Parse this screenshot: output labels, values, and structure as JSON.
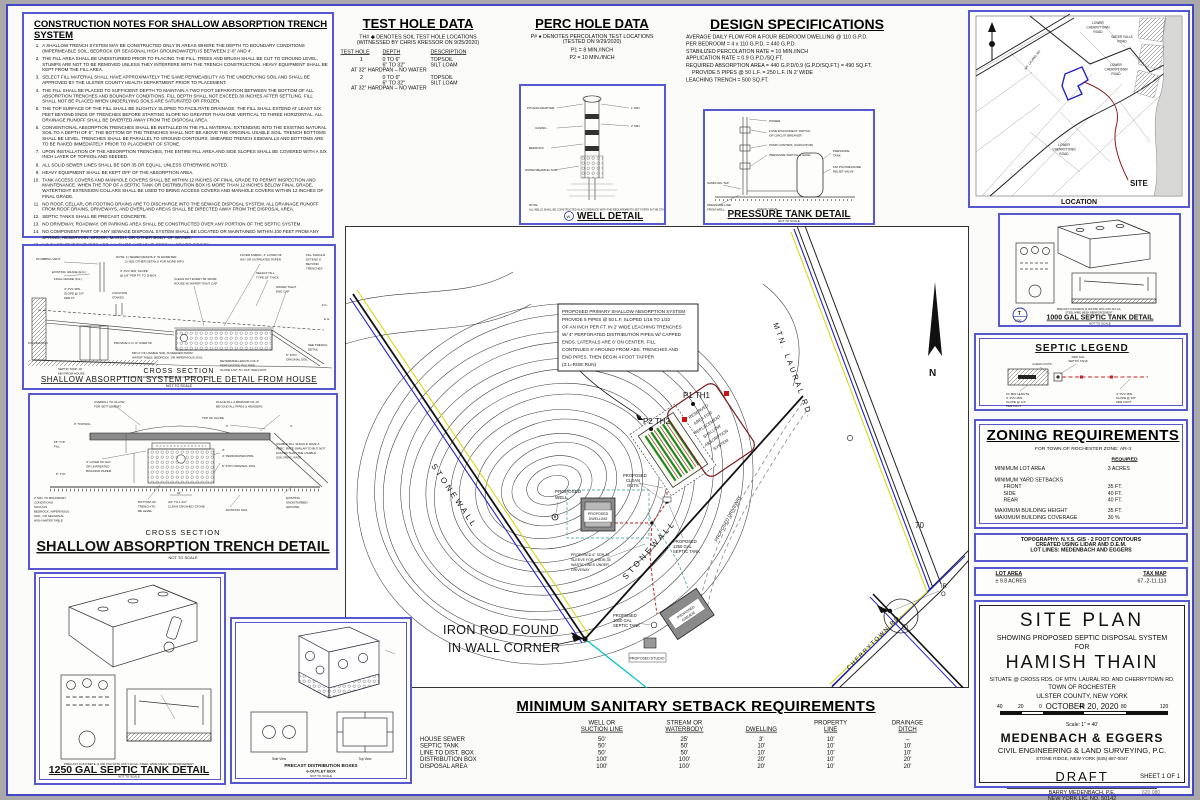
{
  "notes": {
    "title": "CONSTRUCTION NOTES FOR SHALLOW ABSORPTION TRENCH SYSTEM",
    "items": [
      "A SHALLOW TRENCH SYSTEM MAY BE CONSTRUCTED ONLY IN AREAS WHERE THE DEPTH TO BOUNDARY CONDITIONS (IMPERMEABLE SOIL, BEDROCK OR SEASONAL HIGH GROUNDWATER) IS BETWEEN 2'-6\" AND 4'.",
      "THE FILL AREA SHALL BE UNDISTURBED PRIOR TO PLACING THE FILL.  TREES AND BRUSH SHALL BE CUT TO GROUND LEVEL.  STUMPS ARE NOT TO BE REMOVED UNLESS THEY INTERFERE WITH THE TRENCH CONSTRUCTION.  HEAVY EQUIPMENT SHALL BE KEPT FROM THE FILL AREA.",
      "SELECT FILL MATERIAL SHALL HAVE APPROXIMATELY THE SAME PERMEABILITY AS THE UNDERLYING SOIL AND SHALL BE APPROVED BY THE ULSTER COUNTY HEALTH DEPARTMENT PRIOR TO PLACEMENT.",
      "THE FILL SHALL BE PLACED TO SUFFICIENT DEPTH TO MAINTAIN A TWO FOOT SEPARATION BETWEEN THE BOTTOM OF ALL ABSORPTION TRENCHES AND BOUNDARY CONDITIONS.  FILL DEPTH SHALL NOT EXCEED 30 INCHES AFTER SETTLING.  FILL SHALL NOT BE PLACED WHEN UNDERLYING SOILS ARE SATURATED OR FROZEN.",
      "THE TOP SURFACE OF THE FILL SHALL BE SLIGHTLY SLOPED TO FACILITATE DRAINAGE.  THE FILL SHALL EXTEND AT LEAST SIX FEET BEYOND ENDS OF TRENCHES BEFORE STARTING SLOPE NO GREATER THAN ONE VERTICAL TO THREE HORIZONTAL.  ALL DRAINAGE RUNOFF SHALL BE DIVERTED AWAY FROM THE DISPOSAL AREA.",
      "CONVENTIONAL ABSORPTION TRENCHES SHALL BE INSTALLED IN THE FILL MATERIAL, EXTENDING INTO THE EXISTING NATURAL SOIL TO A DEPTH OF 6\".  THE BOTTOM OF THE TRENCHES SHALL NOT BE ABOVE THE ORIGINAL USABLE SOIL.  TRENCH BOTTOMS SHALL BE LEVEL.  TRENCHES SHALL BE PARALLEL TO GROUND CONTOURS.  SMEARED TRENCH SIDEWALLS AND BOTTOMS ARE TO BE RAKED IMMEDIATELY PRIOR TO PLACEMENT OF STONE.",
      "UPON INSTALLATION OF THE ABSORPTION TRENCHES, THE ENTIRE FILL AREA AND SIDE SLOPES SHALL BE COVERED WITH A SIX INCH LAYER OF TOPSOIL AND SEEDED.",
      "ALL SOLID SEWER LINES SHALL BE SDR 35 OR EQUAL, UNLESS OTHERWISE NOTED.",
      "HEAVY EQUIPMENT SHALL BE KEPT OFF OF THE ABSORPTION AREA.",
      "TANK ACCESS COVERS AND MANHOLE COVERS SHALL BE WITHIN 12 INCHES OF FINAL GRADE TO PERMIT INSPECTION AND MAINTENANCE.  WHEN THE TOP OF A SEPTIC TANK OR DISTRIBUTION BOX IS MORE THAN 12 INCHES BELOW FINAL GRADE, WATERTIGHT EXTENSION COLLARS SHALL BE USED TO BRING ACCESS COVERS AND MANHOLE COVERS WITHIN 12 INCHES OF FINAL GRADE.",
      "NO ROOF, CELLAR, OR FOOTING DRAINS ARE TO DISCHARGE INTO THE SEWAGE DISPOSAL SYSTEM.  ALL DRAINAGE RUNOFF FROM ROOF DRAINS, DRIVEWAYS, AND OVERLAND AREAS SHALL BE DIRECTED AWAY FROM THE DISPOSAL AREA.",
      "SEPTIC TANKS SHALL BE PRECAST CONCRETE.",
      "NO DRIVEWAY, ROADWAY, OR PARKING AREA SHALL BE CONSTRUCTED OVER ANY PORTION OF THE SEPTIC SYSTEM.",
      "NO COMPONENT PART OF ANY SEWAGE DISPOSAL SYSTEM SHALL BE LOCATED OR MAINTAINED WITHIN 100 FEET FROM ANY SPRING, RESERVOIR, BROOK, MARSH, OR OTHER BODY OF WATER.",
      "NO BASEMENT FIXTURES ARE ALLOWED WITHOUT SPECIAL SEWER DESIGN.",
      "ALL CONCRETE CHAMBERS TO BE LEVELED ON A BED OF PEA GRAVEL OR SAND"
    ]
  },
  "test": {
    "title": "TEST HOLE DATA",
    "l1": "TH#",
    "l2": "DENOTES SOIL TEST HOLE LOCATIONS",
    "wit": "(WITNESSED BY CHRIS KRESSOR ON 9/25/2020)",
    "h1": "TEST HOLE",
    "h2": "DEPTH",
    "h3": "DESCRIPTION",
    "r1": {
      "id": "1",
      "a1": "0 TO 6\"",
      "b1": "TOPSOIL",
      "a2": "6\" TO 32\"",
      "b2": "SILT LOAM",
      "f": "AT 32\" HARDPAN – NO WATER"
    },
    "r2": {
      "id": "2",
      "a1": "0 TO 6\"",
      "b1": "TOPSOIL",
      "a2": "6\" TO 32\"",
      "b2": "SILT LOAM",
      "f": "AT 32\" HARDPAN – NO WATER"
    }
  },
  "perc": {
    "title": "PERC HOLE DATA",
    "l1": "P#",
    "l2": "DENOTES PERCOLATION TEST LOCATIONS",
    "t": "(TESTED ON 9/29/2020)",
    "p1": "P1 = 8 MIN./INCH",
    "p2": "P2 = 10 MIN./INCH"
  },
  "specs": {
    "title": "DESIGN SPECIFICATIONS",
    "lines": [
      "AVERAGE DAILY FLOW FOR A FOUR BEDROOM DWELLING @ 110 G.P.D.",
      "PER BEDROOM = 4 x 110 G.P.D. = 440 G.P.D.",
      "STABILIZED PERCOLATION RATE = 10 MIN./INCH",
      "APPLICATION RATE = 0.9 G.P.D./SQ.FT.",
      "REQUIRED ABSORPTION AREA = 440 G.P.D/0.9 (G.P.D/SQ.FT.) = 490 SQ.FT.",
      "PROVIDE 5 PIPES @ 50 L.F. = 250 L.F. IN 2' WIDE",
      "LEACHING TRENCH = 500 SQ.FT."
    ]
  },
  "well": {
    "title": "WELL DETAIL",
    "nts": "NOT TO SCALE",
    "sym": "W",
    "note1": "NOTE:",
    "note2": "ALL WELLS SHALL BE CONSTRUCTED IN ACCORDANCE WITH THE REQUIREMENTS SET FORTH IN THE STANDARDS FOR WATER WELLS",
    "pitless": "PITLESS ADAPTER",
    "casing": "CASING",
    "bedrock": "BEDROCK",
    "water": "WATER BEARING SOIL",
    "m1": "1' MIN",
    "m2": "2' MIN"
  },
  "ptank": {
    "title": "PRESSURE TANK DETAIL",
    "nts": "NOT TO SCALE",
    "power": "POWER",
    "fuse1": "FUSE DISCONNECT SWITCH",
    "fuse2": "OR CIRCUIT BREAKER",
    "pump": "PUMP CONTROL (CAPACITOR)",
    "psw": "PRESSURE SWITCH & GAGE",
    "tank1": "PRESSURE",
    "tank2": "TANK",
    "rv1": "150 PSI PRESSURE",
    "rv2": "RELIEF VALVE",
    "tap": "SAMPLING TAP",
    "pl1": "PRESSURE LINE",
    "pl2": "FROM WELL",
    "cv": "CHECK VALVE"
  },
  "loc": {
    "caption": "LOCATION",
    "site": "SITE",
    "mtl": "MT. LAUREL RD",
    "lt1": "LOWER",
    "lt2": "CHERRYTOWN",
    "lt3": "ROAD",
    "wf1": "WATER FALLS",
    "wf2": "ROAD",
    "mid1": "LOWER",
    "mid2": "CHERRYTOWN",
    "mid3": "ROAD",
    "bot1": "LOWER",
    "bot2": "CHERRYTOWN",
    "bot3": "ROAD"
  },
  "t1000": {
    "title": "1000 GAL SEPTIC TANK DETAIL",
    "nts": "NOT TO SCALE",
    "note1": "PRECAST CONCRETE (4,000 PSI) WITH 6X6 X10 GA.",
    "note2": "STEEL WIRE MESH REINFORCEMENT",
    "symT": "T",
    "symN": "1000"
  },
  "legend": {
    "title": "SEPTIC LEGEND",
    "tk1": "1000 GAL",
    "tk2": "SEPTIC TANK",
    "co": "CLEAN OUTS",
    "ln1": "10' MIN LENGTH",
    "ln2": "4\" PVC MIN.",
    "ln3": "SLOPE @ 1/4\"",
    "ln4": "PER FOOT",
    "rn1": "4\" PVC MIN.",
    "rn2": "SLOPE @ 1/8\"",
    "rn3": "PER FOOT"
  },
  "zoning": {
    "title": "ZONING REQUIREMENTS",
    "subtitle": "FOR TOWN OF ROCHESTER ZONE: AR-3",
    "req": "REQUIRED",
    "r1": {
      "l": "MINIMUM LOT AREA",
      "v": "3 ACRES"
    },
    "r2": {
      "l": "MINIMUM YARD SETBACKS",
      "v": ""
    },
    "r3": {
      "l": "FRONT",
      "v": "35 FT."
    },
    "r4": {
      "l": "SIDE",
      "v": "40 FT."
    },
    "r5": {
      "l": "REAR",
      "v": "40 FT."
    },
    "r6": {
      "l": "MAXIMUM BUILDING HEIGHT",
      "v": "35 FT."
    },
    "r7": {
      "l": "MAXIMUM BUILDING COVERAGE",
      "v": "30 %"
    }
  },
  "topo": {
    "l1": "TOPOGRAPHY:  N.Y.S. GIS - 2 FOOT CONTOURS",
    "l2": "CREATED USING LIDAR AND D.E.M.",
    "l3": "LOT LINES: MEDENBACH AND EGGERS"
  },
  "lot": {
    "h1": "LOT AREA",
    "v1": "± 9.8 ACRES",
    "h2": "TAX MAP",
    "v2": "67.-2-11.113"
  },
  "tb": {
    "t1": "SITE PLAN",
    "t2": "SHOWING PROPOSED SEPTIC DISPOSAL SYSTEM",
    "t3": "FOR",
    "t4": "HAMISH THAIN",
    "t5": "SITUATE @ CROSS RDS. OF MTN. LAURAL RD. AND CHERRYTOWN RD.",
    "t6": "TOWN OF ROCHESTER",
    "t7": "ULSTER COUNTY, NEW YORK",
    "t8": "OCTOBER 20, 2020",
    "ticks": [
      "40",
      "20",
      "0",
      "40",
      "80",
      "120"
    ],
    "scale": "Scale: 1\" = 40'",
    "firm": "MEDENBACH & EGGERS",
    "firm2": "CIVIL ENGINEERING & LAND SURVEYING, P.C.",
    "firm3": "STONE RIDGE, NEW YORK  (845) 687-0047",
    "draft": "DRAFT",
    "eng": "BARRY MEDENBACH, P.E.",
    "lic": "NEW YORK LIC. NO. 50142",
    "sheet": "SHEET 1 OF 1",
    "docnum": "620 080"
  },
  "sb": {
    "title": "MINIMUM SANITARY SETBACK REQUIREMENTS",
    "h": [
      [
        "WELL OR",
        "SUCTION LINE"
      ],
      [
        "STREAM OR",
        "WATERBODY"
      ],
      [
        "",
        "DWELLING"
      ],
      [
        "PROPERTY",
        "LINE"
      ],
      [
        "DRAINAGE",
        "DITCH"
      ]
    ],
    "rows": [
      [
        "HOUSE SEWER",
        "50'",
        "25'",
        "3'",
        "10'",
        "–"
      ],
      [
        "SEPTIC TANK",
        "50'",
        "50'",
        "10'",
        "10'",
        "10'"
      ],
      [
        "LINE TO DIST. BOX",
        "50'",
        "50'",
        "10'",
        "10'",
        "10'"
      ],
      [
        "DISTRIBUTION BOX",
        "100'",
        "100'",
        "20'",
        "10'",
        "20'"
      ],
      [
        "DISPOSAL AREA",
        "100'",
        "100'",
        "20'",
        "10'",
        "20'"
      ]
    ]
  },
  "plan": {
    "road_a": "MTN. LAURAL RD.",
    "road_b": "CHERRYTOWN RD.",
    "wall": "STONEWALL",
    "c70": "70",
    "north": "N",
    "rod1": "IRON ROD FOUND",
    "rod2": "IN WALL CORNER",
    "p1": "P1 TH1",
    "p2": "P2 TH2",
    "well1": "PROPOSED",
    "well2": "WELL",
    "dw1": "PROPOSED",
    "dw2": "DWELLING",
    "co1": "PROPOSED",
    "co2": "CLEAN",
    "co3": "OUTS",
    "sl1": "PROPOSED 6\" SDR-35",
    "sl2": "SLEEVE FOR 4\"SDR-35",
    "sl3": "WASTE LINES UNDER",
    "sl4": "DRIVEWAY",
    "t12_1": "PROPOSED",
    "t12_2": "1250 GAL",
    "t12_3": "SEPTIC TANK",
    "t10_1": "PROPOSED",
    "t10_2": "1000 GAL",
    "t10_3": "SEPTIC TANK",
    "drv": "PROPOSED DRIVEWAY",
    "gar1": "PROPOSED",
    "gar2": "GARAGE",
    "studio": "PROPOSED STUDIO",
    "clip1": "IR",
    "clip2": "O",
    "nb1": "PROPOSED PRIMARY SHALLOW ABSORPTION SYSTEM",
    "nb2": "PROVIDE 5 PIPES @ 50 L.F, SLOPED 1/16 TO 1/32",
    "nb3": "OF AN INCH PER FT. IN 2' WIDE LEACHING TRENCHES",
    "nb4": "W/  4\" PERFORATED DISTRIBUTION PIPES W/ CAPPED",
    "nb5": "ENDS.  LATERALS ARE 6' ON CENTER. FILL",
    "nb6": "CONTINUES 6' AROUND FROM  ABS. TRENCHES AND",
    "nb7": "END PIPES. THEN BEGIN 4 FOOT TAPPER",
    "nb8": "(3:1=RISE:RUN)",
    "rv1": "RESERVED",
    "rv2": "AREA FOR",
    "rv3": "REPLACEMENT",
    "rv4": "SHALLOW",
    "rv5": "ABSORPTION",
    "rv6": "SYSTEM"
  },
  "profile": {
    "cross": "CROSS SECTION",
    "title": "SHALLOW ABSORPTION SYSTEM PROFILE DETAIL FROM HOUSE",
    "nts": "NOT TO SCALE",
    "vent": "PLUMBING VENT",
    "eg": "EXISTING GRADE (E.G.)",
    "fg": "FINAL GRADE (F.G.)",
    "pvc14a": "4\" PVC MIN.",
    "pvc14b": "SLOPE @ 1/4\"",
    "pvc14c": "PER FT.",
    "stakes1": "LOCATION",
    "stakes2": "STAKES",
    "n1": "NOTE: 1) SEWER DRAINS 4\" IN DIAMETER",
    "n2": "2) SEE OTHER DETAILS FOR MORE INFO",
    "pvc18a": "4\" PVC MIN. SLOPE",
    "pvc18b": "@ 1/8\" PER FT. TO D-BOX",
    "coa": "CLEAN OUT EVERY 50' FROM",
    "cob": "HOUSE W/ WATER TIGHT CAP",
    "fa1": "FILTER FABRIC, 4\" LAYER OF",
    "fa2": "HAY OR UNTREATED PAPER",
    "sf1": "SELECT FILL",
    "sf2": "TYPE 18\" THICK",
    "ex1": "FILL SHOULD",
    "ex2": "EXTEND 6'",
    "ex3": "BEYOND",
    "ex4": "TRENCHES",
    "cap1": "WATER TIGHT",
    "cap2": "END CAP",
    "found": "FOUNDATION",
    "st1": "SEPTIC TANK 10'",
    "st2": "MIN FROM HOUSE",
    "pr": "PROVIDE C.O. IF OVER 50'",
    "us1": "MIN 2' OF USABLE SOIL IS NEEDED FROM",
    "us2": "WATER TABLE, BEDROCK, OR IMPERVIOUS SOIL",
    "bd": "BOUNDARY OF WATER TABLE, BEDROCK, OR IMPERVIOUS SOIL",
    "ln1": "DETERMINE LENGTH OF 4\"",
    "ln2": "PERFORATED PVC PIPE",
    "ln3": "SLOPE 1/32\" TO 1/16\" PER FOOT",
    "td1": "SEE TRENCH",
    "td2": "DETAIL",
    "og1": "6\" INTO",
    "og2": "ORIGINAL SOIL",
    "fg2": "F.G.",
    "eg2": "E.G."
  },
  "trench": {
    "cross": "CROSS SECTION",
    "title": "SHALLOW ABSORPTION TRENCH DETAIL",
    "nts": "NOT TO SCALE",
    "ov1": "OVERFILL TO ALLOW",
    "ov2": "FOR SETTLEMENT",
    "ts": "6\" TOPSOIL",
    "f18a": "18\" TYP.",
    "f18b": "FILL",
    "t6": "6\" TYP.",
    "b1": "2' MIN. TO BOUNDARY",
    "b2": "CONDITIONS",
    "b3": "SUCH AS",
    "b4": "BEDROCK, IMPERVIOUS",
    "b5": "SOIL, OR SEASONAL",
    "b6": "HIGH WATER TABLE",
    "hay1": "4\" LAYER OF HAY",
    "hay2": "OR UNTREATED",
    "hay3": "BUILDING PAPER",
    "bt1": "BOTTOM OF",
    "bt2": "TRENCH TO",
    "bt3": "BE LEVEL",
    "cs1": "3/4\" TO 1-1/2\"",
    "cs2": "CLEAN CRUSHED STONE",
    "d24": "24\"",
    "pl1": "PLACE FILL A MINIMUM OF 10'",
    "pl2": "BEYOND ALL PIPES & HEADERS",
    "tos": "TOP OF SLOPE",
    "d6": "6'",
    "d4": "4'",
    "d3": "3\"",
    "uf1": "USABLE FILL SHOULD HAVE A",
    "uf2": "PERC. RATE SIMILAR TO BUT NOT",
    "uf3": "FASTER THAN THE USABLE",
    "uf4": "SOIL PERC. RATE",
    "pp": "4\" PERFORATED PIPE",
    "io": "6\" INTO ORIGINAL SOIL",
    "eu1": "EXISTING",
    "eu2": "UNDISTURBED",
    "eu3": "GROUND",
    "es": "EXISTING SOIL"
  },
  "t1250": {
    "title": "1250 GAL SEPTIC TANK DETAIL",
    "nts": "NOT TO SCALE",
    "note": "PRECAST CONCRETE (4,000 PSI) WITH 6X6 X10 GA. STEEL WIRE MESH REINFORCEMENT"
  },
  "dbox": {
    "t1": "PRECAST DISTRIBUTION BOXES",
    "t2": "6-OUTLET BOX",
    "nts": "NOT TO SCALE",
    "side": "Side View",
    "top": "Top View"
  }
}
